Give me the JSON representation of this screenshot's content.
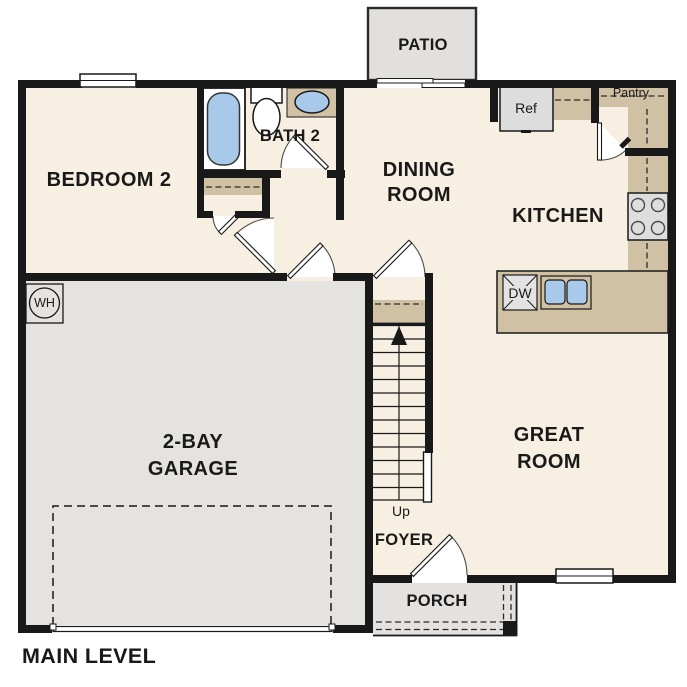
{
  "plan": {
    "title": "MAIN LEVEL",
    "rooms": {
      "patio": "PATIO",
      "bedroom2": "BEDROOM 2",
      "bath2": "BATH 2",
      "dining_line1": "DINING",
      "dining_line2": "ROOM",
      "kitchen": "KITCHEN",
      "pantry": "Pantry",
      "great_line1": "GREAT",
      "great_line2": "ROOM",
      "garage_line1": "2-BAY",
      "garage_line2": "GARAGE",
      "foyer": "FOYER",
      "porch": "PORCH"
    },
    "fixtures": {
      "refrigerator": "Ref",
      "dishwasher": "DW",
      "water_heater": "WH",
      "stairs_direction": "Up"
    },
    "colors": {
      "wall": "#191919",
      "floor": "#f7efe1",
      "garage_floor": "#e4e3e0",
      "porch_floor": "#e3e2e0",
      "patio_floor": "#e1e0de",
      "counter_tan": "#d1c1a4",
      "fixture_blue": "#a9c9eb",
      "appliance_gray": "#dddddd"
    }
  }
}
